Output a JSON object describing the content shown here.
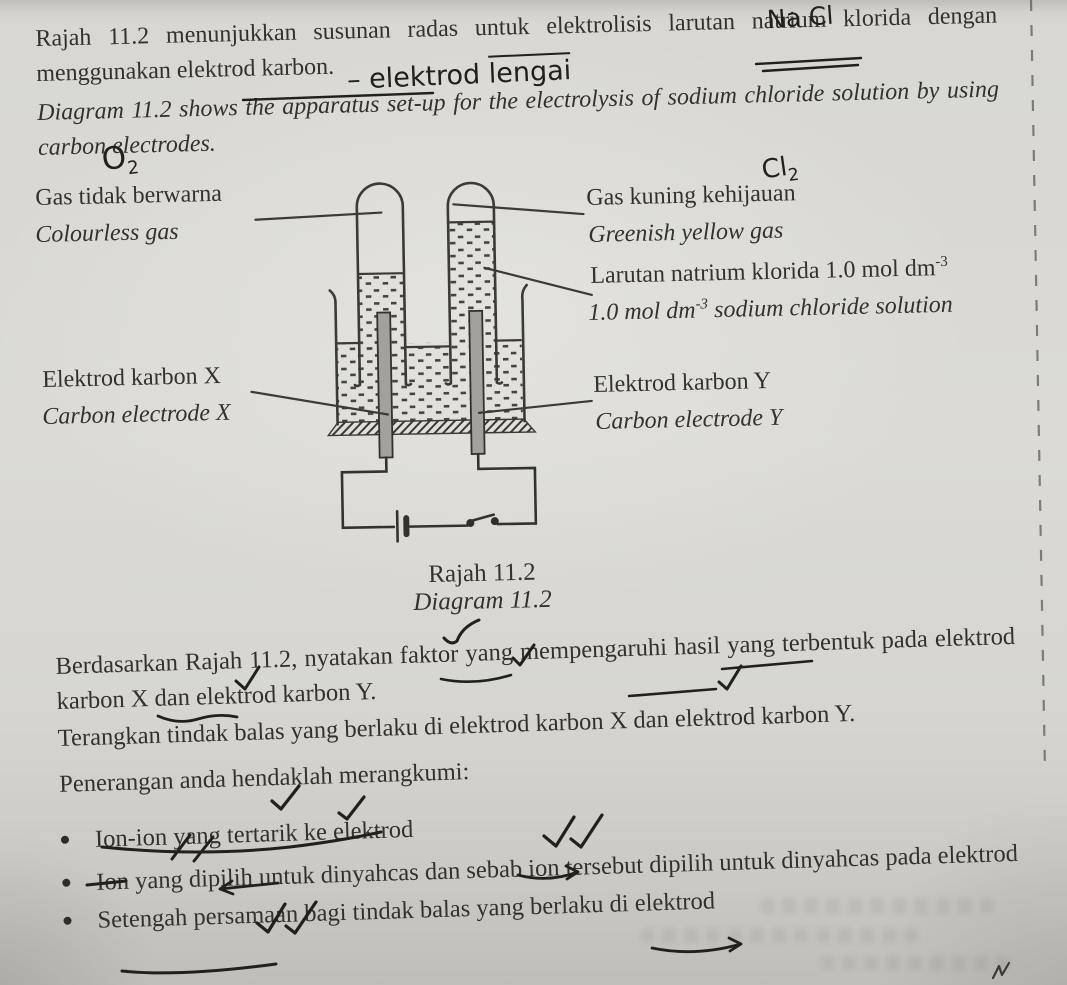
{
  "title": {
    "intro_ms": "Rajah 11.2 menunjukkan susunan radas untuk elektrolisis larutan natrium klorida dengan menggunakan elektrod karbon.",
    "intro_en": "Diagram 11.2 shows the apparatus set-up for the electrolysis of sodium chloride solution by using carbon electrodes."
  },
  "handwriting": {
    "nacl": "Na Cl",
    "dash_elektrod": "– elektrod",
    "lengai": "lengai",
    "o": "O",
    "o_sub": "2",
    "cl": "Cl",
    "cl_sub": "2"
  },
  "diagram": {
    "labels": {
      "colourless_ms": "Gas tidak berwarna",
      "colourless_en": "Colourless gas",
      "greenish_ms": "Gas kuning kehijauan",
      "greenish_en": "Greenish yellow gas",
      "sol_ms_pre": "Larutan natrium klorida 1.0 mol dm",
      "sol_exp": "-3",
      "sol_en_pre": "1.0 mol dm",
      "sol_en_post": " sodium chloride solution",
      "electrode_x_ms": "Elektrod karbon X",
      "electrode_x_en": "Carbon electrode X",
      "electrode_y_ms": "Elektrod karbon Y",
      "electrode_y_en": "Carbon electrode Y"
    },
    "caption_ms": "Rajah 11.2",
    "caption_en": "Diagram 11.2"
  },
  "questions": {
    "q1": "Berdasarkan Rajah 11.2, nyatakan faktor yang mempengaruhi hasil yang terbentuk pada elektrod karbon X dan elektrod karbon Y.",
    "q2": "Terangkan tindak balas yang berlaku di elektrod karbon X dan elektrod karbon Y.",
    "q3": "Penerangan anda hendaklah merangkumi:",
    "bullets": [
      "Ion-ion yang tertarik ke elektrod",
      "Ion yang dipilih untuk dinyahcas dan sebab ion tersebut dipilih untuk dinyahcas pada elektrod",
      "Setengah persamaan bagi tindak balas yang berlaku di elektrod"
    ]
  },
  "colors": {
    "paper": "#d8d7d3",
    "ink": "#33312c",
    "pen": "#21201e",
    "electrode_gray": "#a2a19d"
  }
}
